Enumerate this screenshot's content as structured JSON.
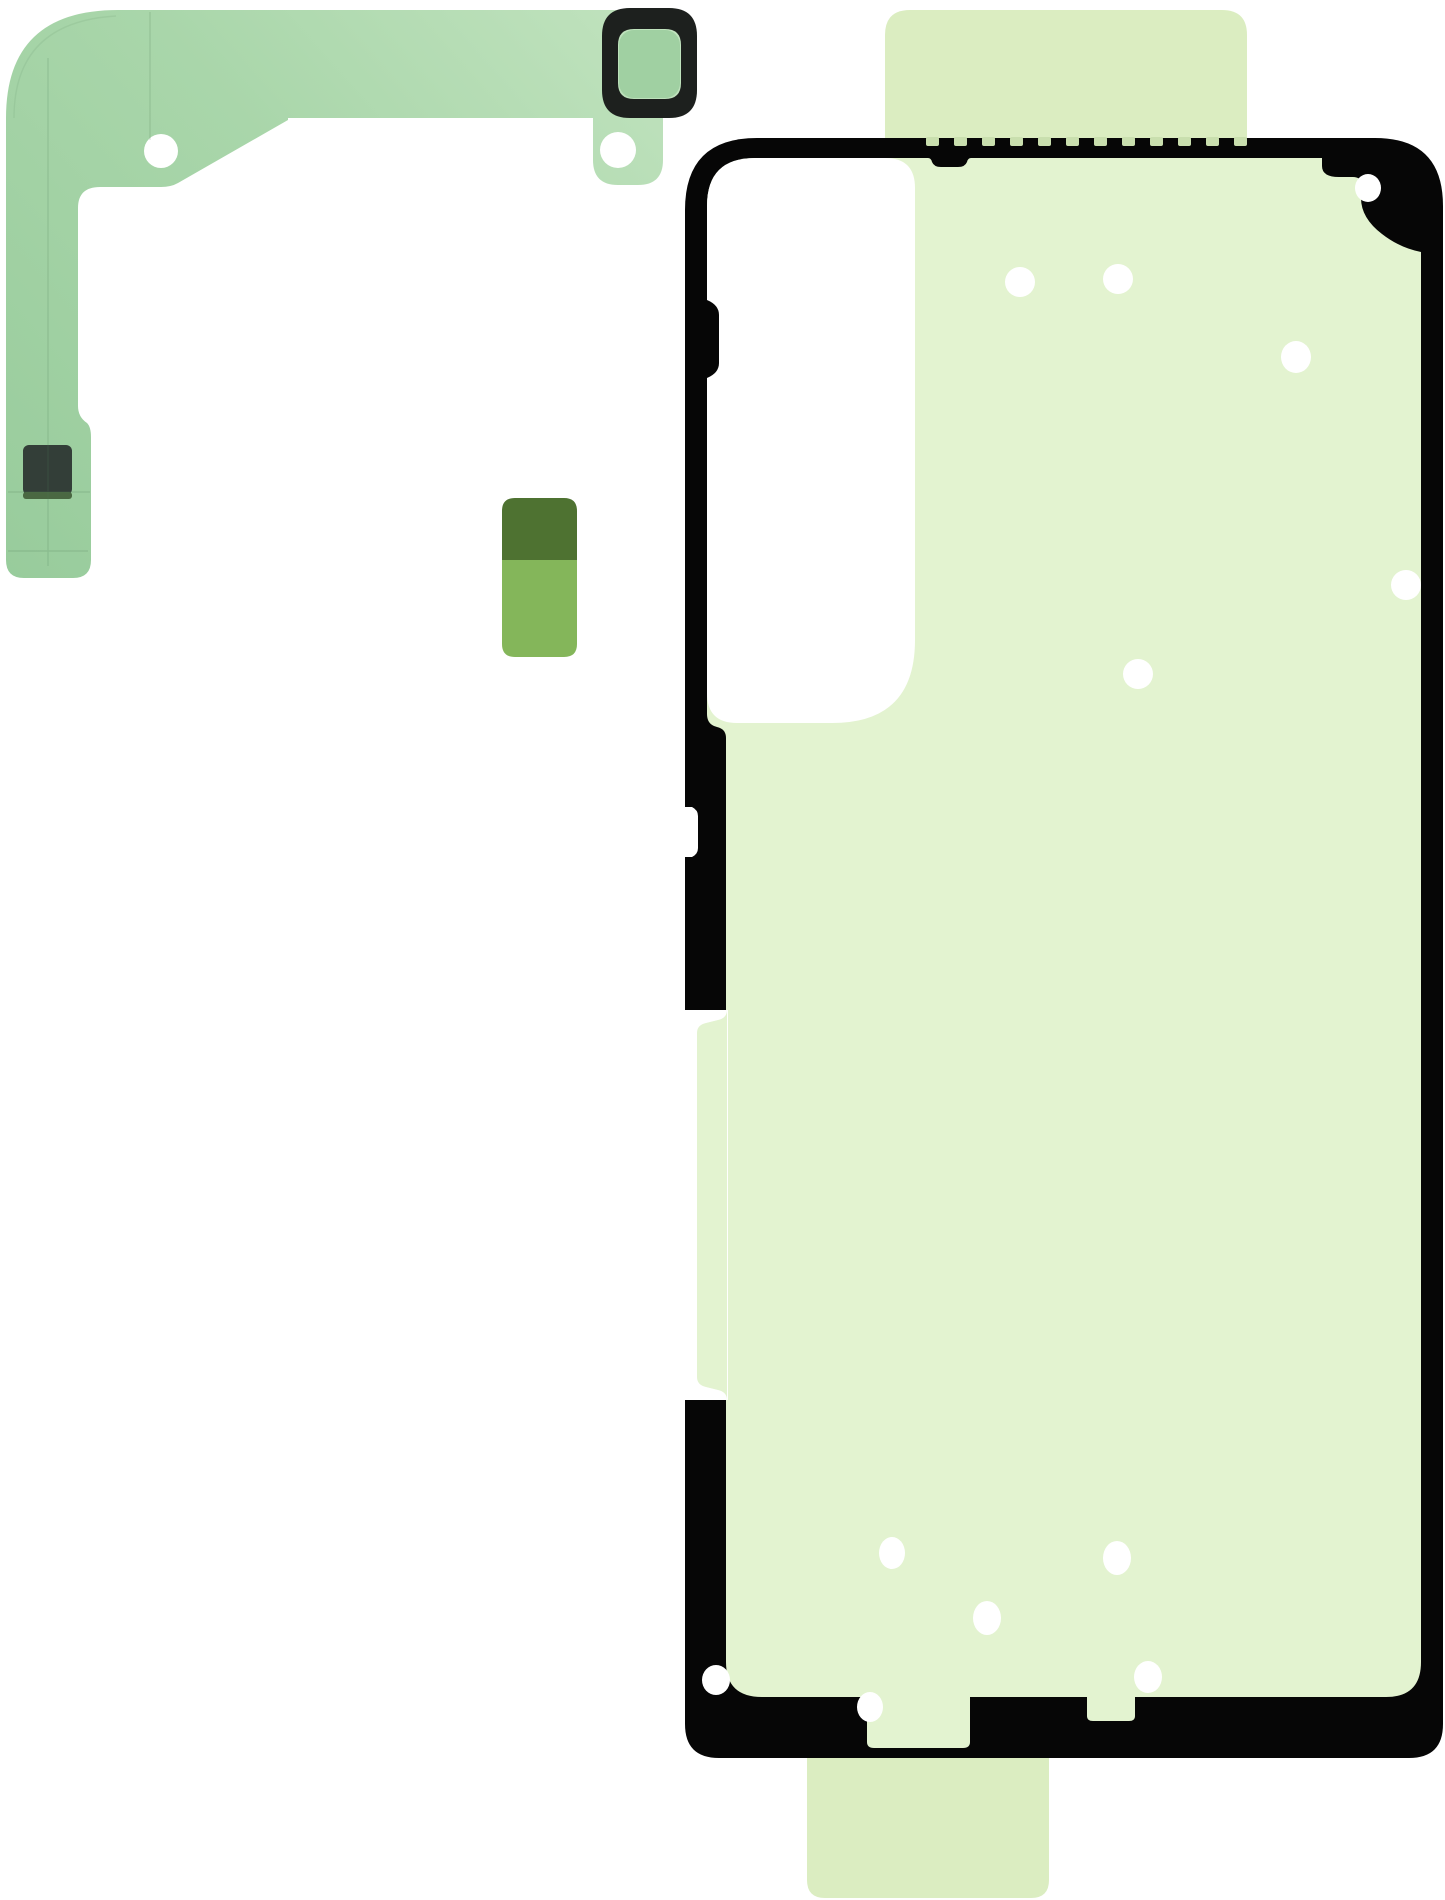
{
  "meta": {
    "description": "Product photo: smartphone back-cover adhesive tape rework kit with camera flex adhesive strip, spacer sticker and rear cover gasket on white background",
    "background": "#ffffff"
  },
  "colors": {
    "background_white": "#ffffff",
    "flex_green_light": "#c3e4c0",
    "flex_green": "#a9d6aa",
    "flex_green_deep": "#97cb9b",
    "ring_black": "#1d201e",
    "ring_inner_green": "#a0d0a2",
    "pad_dark": "#333e38",
    "pad_accent": "#4a6842",
    "crease_line": "#4c7a55",
    "sticker_dark": "#4e7231",
    "sticker_light": "#84b65a",
    "tab_green": "#dbedc1",
    "interior_green": "#e3f3d0",
    "outline_black": "#060606",
    "dash_green": "#c9dfae",
    "dot_white": "#ffffff"
  },
  "parts": {
    "camera_flex_adhesive": {
      "label": "camera-flex-adhesive-strip",
      "holes": [
        {
          "cx": 161,
          "cy": 151,
          "r": 17
        },
        {
          "cx": 618,
          "cy": 150,
          "r": 18
        }
      ]
    },
    "spacer_sticker": {
      "label": "two-tone-spacer-sticker"
    },
    "back_cover_adhesive": {
      "label": "rear-cover-adhesive-gasket",
      "dots": [
        {
          "cx": 1020,
          "cy": 282,
          "rx": 15,
          "ry": 15
        },
        {
          "cx": 1118,
          "cy": 279,
          "rx": 15,
          "ry": 15
        },
        {
          "cx": 1296,
          "cy": 357,
          "rx": 15,
          "ry": 16
        },
        {
          "cx": 1368,
          "cy": 188,
          "rx": 13,
          "ry": 14
        },
        {
          "cx": 1406,
          "cy": 585,
          "rx": 15,
          "ry": 15
        },
        {
          "cx": 1138,
          "cy": 674,
          "rx": 15,
          "ry": 15
        },
        {
          "cx": 892,
          "cy": 1553,
          "rx": 13,
          "ry": 16
        },
        {
          "cx": 1117,
          "cy": 1558,
          "rx": 14,
          "ry": 17
        },
        {
          "cx": 987,
          "cy": 1618,
          "rx": 14,
          "ry": 17
        },
        {
          "cx": 716,
          "cy": 1680,
          "rx": 14,
          "ry": 15
        },
        {
          "cx": 870,
          "cy": 1707,
          "rx": 13,
          "ry": 15
        },
        {
          "cx": 1148,
          "cy": 1677,
          "rx": 14,
          "ry": 16
        }
      ],
      "top_edge_dashes": {
        "start_x": 926,
        "y": 137,
        "width": 13,
        "gap": 15,
        "height": 9,
        "count": 12
      }
    }
  }
}
